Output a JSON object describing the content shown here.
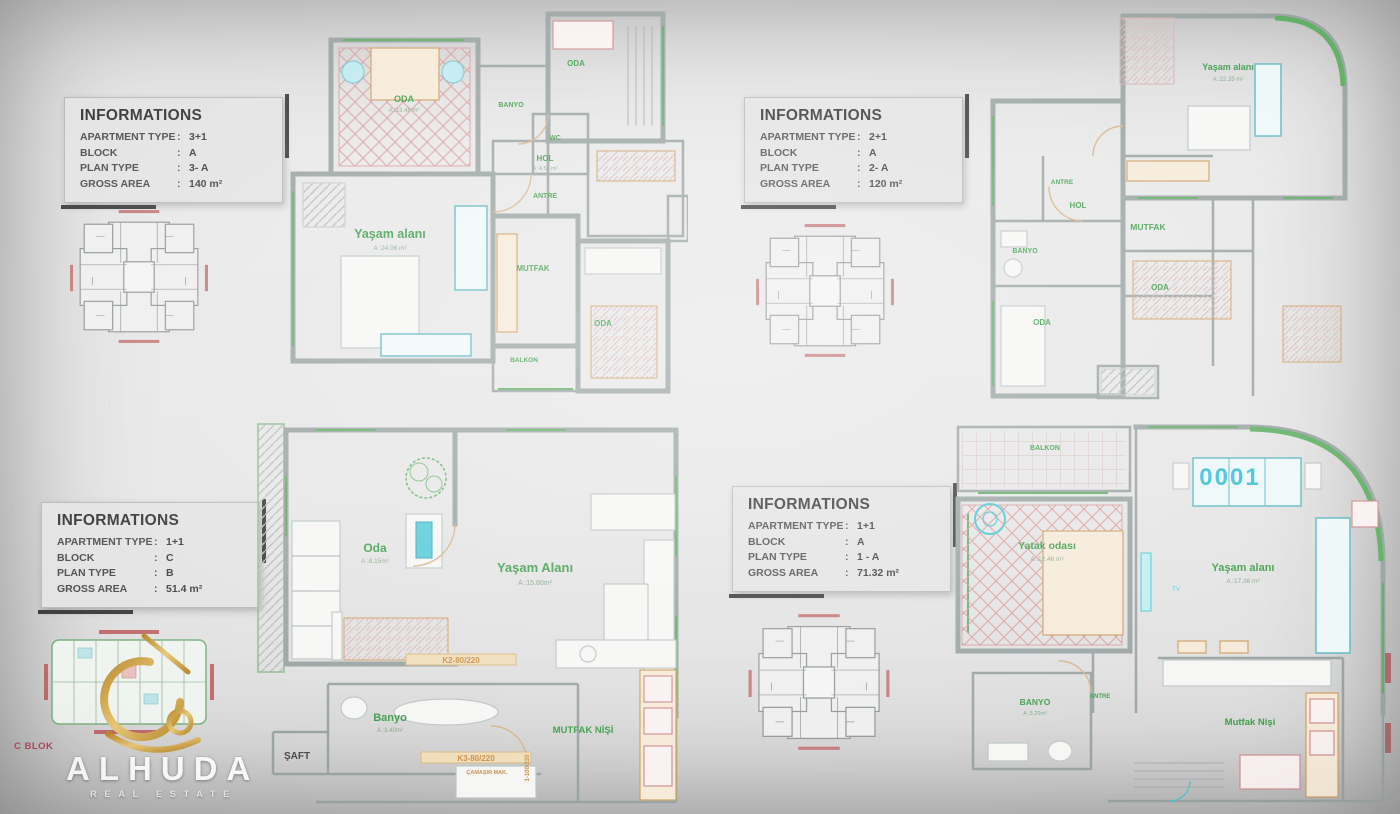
{
  "ui": {
    "colon": ":"
  },
  "info_boxes": [
    {
      "title": "INFORMATIONS",
      "rows": [
        {
          "label": "APARTMENT TYPE",
          "value": "3+1"
        },
        {
          "label": "BLOCK",
          "value": "A"
        },
        {
          "label": "PLAN TYPE",
          "value": "3- A"
        },
        {
          "label": "GROSS AREA",
          "value": "140 m²"
        }
      ]
    },
    {
      "title": "INFORMATIONS",
      "rows": [
        {
          "label": "APARTMENT TYPE",
          "value": "2+1"
        },
        {
          "label": "BLOCK",
          "value": "A"
        },
        {
          "label": "PLAN TYPE",
          "value": "2- A"
        },
        {
          "label": "GROSS AREA",
          "value": "120 m²"
        }
      ]
    },
    {
      "title": "INFORMATIONS",
      "rows": [
        {
          "label": "APARTMENT TYPE",
          "value": "1+1"
        },
        {
          "label": "BLOCK",
          "value": "C"
        },
        {
          "label": "PLAN TYPE",
          "value": "B"
        },
        {
          "label": "GROSS AREA",
          "value": "51.4 m²"
        }
      ]
    },
    {
      "title": "INFORMATIONS",
      "rows": [
        {
          "label": "APARTMENT TYPE",
          "value": "1+1"
        },
        {
          "label": "BLOCK",
          "value": "A"
        },
        {
          "label": "PLAN TYPE",
          "value": "1 - A"
        },
        {
          "label": "GROSS AREA",
          "value": "71.32 m²"
        }
      ]
    }
  ],
  "plans": [
    {
      "name": "plan-3A",
      "rooms": {
        "oda_tl": {
          "name": "ODA",
          "area": "A :13.48 m²"
        },
        "banyo": {
          "name": "BANYO"
        },
        "wc": {
          "name": "WC"
        },
        "oda_top": {
          "name": "ODA"
        },
        "hol": {
          "name": "HOL",
          "area": "A :4.53 m²"
        },
        "antre": {
          "name": "ANTRE"
        },
        "yasam": {
          "name": "Yaşam alanı",
          "area": "A :24.06 m²"
        },
        "mutfak": {
          "name": "MUTFAK"
        },
        "oda_br": {
          "name": "ODA"
        },
        "balkon": {
          "name": "BALKON"
        }
      }
    },
    {
      "name": "plan-2A",
      "rooms": {
        "yasam": {
          "name": "Yaşam alanı",
          "area": "A :22.35 m²"
        },
        "antre": {
          "name": "ANTRE"
        },
        "hol": {
          "name": "HOL"
        },
        "mutfak": {
          "name": "MUTFAK"
        },
        "banyo": {
          "name": "BANYO"
        },
        "oda_r": {
          "name": "ODA"
        },
        "oda_b": {
          "name": "ODA"
        }
      }
    },
    {
      "name": "plan-B",
      "rooms": {
        "oda": {
          "name": "Oda",
          "area": "A :8.15m²"
        },
        "yasam": {
          "name": "Yaşam Alanı",
          "area": "A :15.80m²"
        },
        "banyo": {
          "name": "Banyo",
          "area": "A :3.40m²"
        },
        "saft": {
          "name": "ŞAFT"
        },
        "mutfak_nisi": {
          "name": "MUTFAK NİŞİ"
        },
        "tag_k2": {
          "name": "K2-80/220"
        },
        "tag_k3": {
          "name": "K3-80/220"
        },
        "tag_camasir": {
          "name": "ÇAMAŞIR MAK."
        },
        "tag_door": {
          "name": "1-100/220"
        }
      }
    },
    {
      "name": "plan-1A",
      "unit_number": "0001",
      "rooms": {
        "balkon": {
          "name": "BALKON"
        },
        "yatak": {
          "name": "Yatak odası",
          "area": "A :12.46 m²"
        },
        "yasam": {
          "name": "Yaşam alanı",
          "area": "A :17.36 m²"
        },
        "banyo": {
          "name": "BANYO",
          "area": "A :3.20m²"
        },
        "antre": {
          "name": "ANTRE"
        },
        "mutfak_nisi": {
          "name": "Mutfak Nişi"
        },
        "tv": {
          "name": "TV"
        }
      }
    }
  ],
  "logo": {
    "name": "ALHUDA",
    "tagline": "REAL ESTATE",
    "block_label": "C BLOK"
  },
  "colors": {
    "room_label_green": "#3f9d4b",
    "wall_gray": "#9aa3a3",
    "accent_cyan": "#49c6d2",
    "carpet_red": "#d28f8f",
    "furniture_tan": "#cf9f63",
    "gold": "#c9a14a",
    "block_label_red": "#b2475a",
    "unit_number_cyan": "#3bbfd8"
  }
}
